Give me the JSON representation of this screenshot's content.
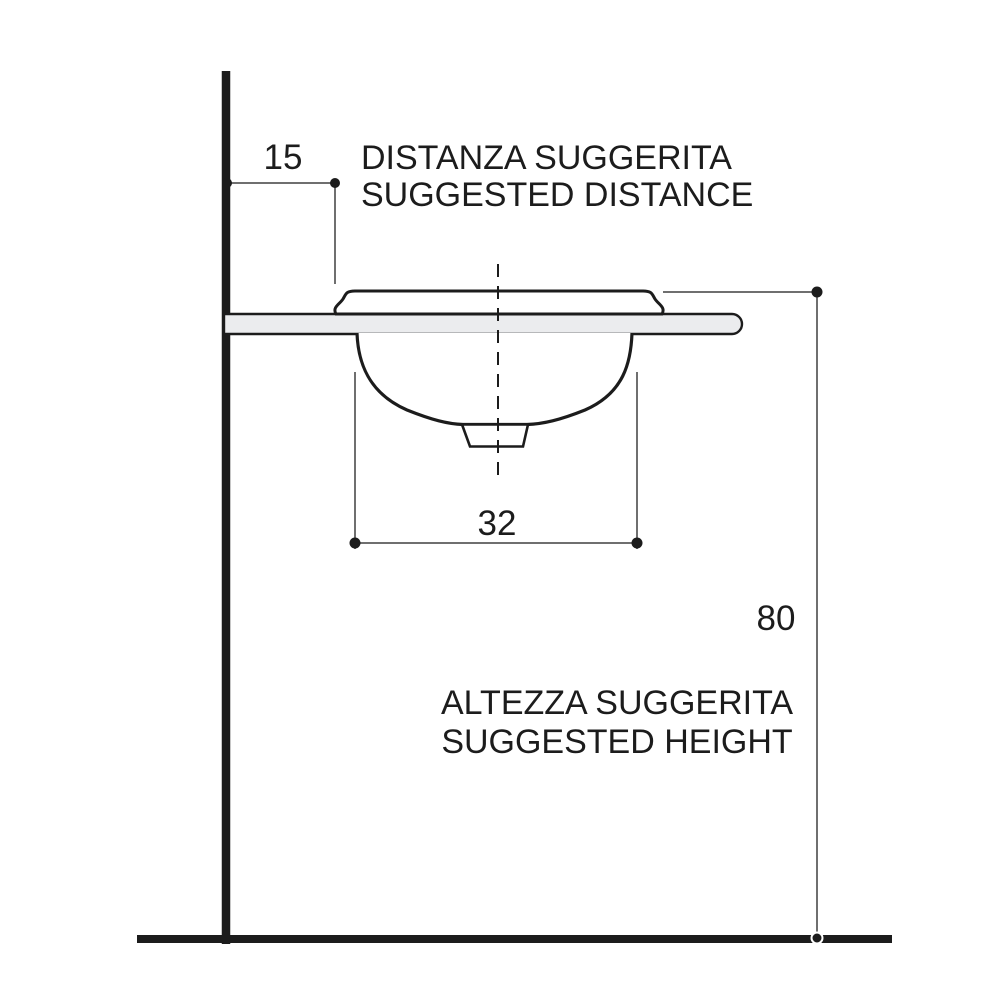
{
  "labels": {
    "distance_value": "15",
    "width_value": "32",
    "height_value": "80",
    "distance_title_line1": "DISTANZA SUGGERITA",
    "distance_title_line2": "SUGGESTED DISTANCE",
    "height_title_line1": "ALTEZZA SUGGERITA",
    "height_title_line2": "SUGGESTED HEIGHT"
  },
  "colors": {
    "line": "#1c1c1c",
    "dim": "#6f6f6f",
    "countertop": "#ebecee",
    "text": "#1c1c1c",
    "bg": "#ffffff"
  }
}
